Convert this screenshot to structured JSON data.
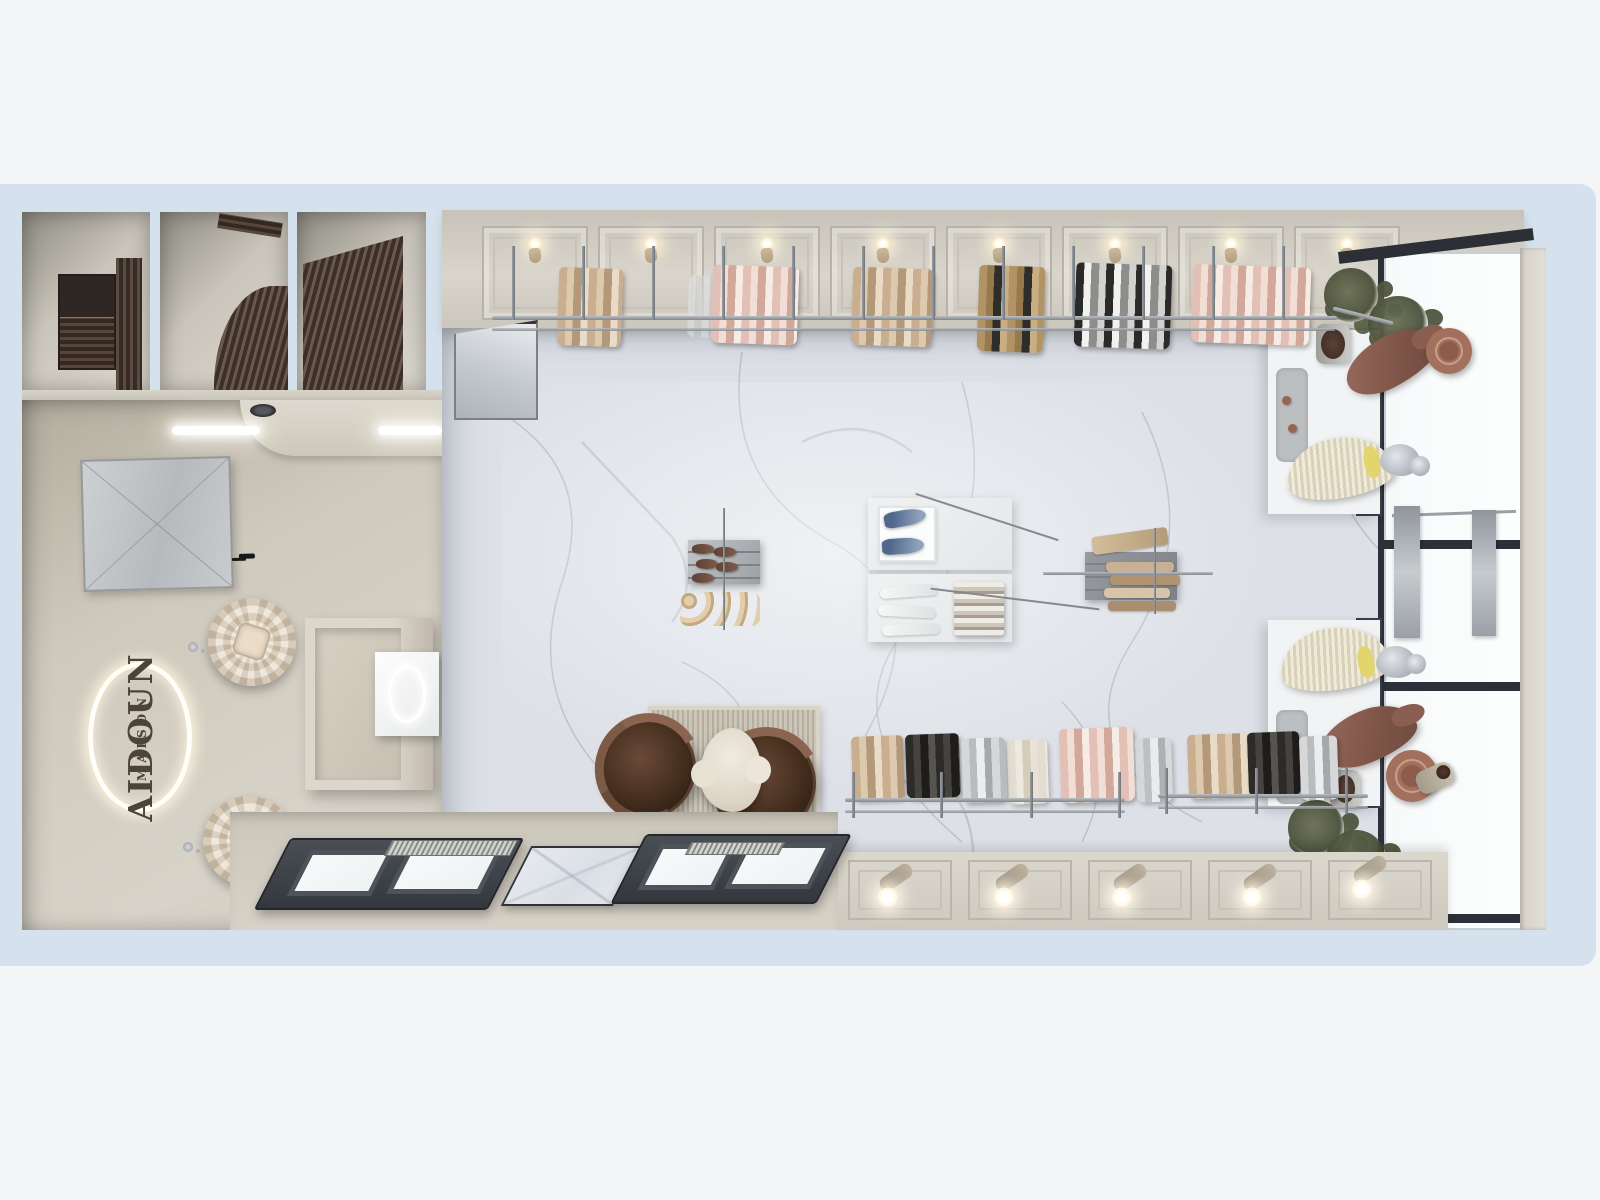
{
  "scene": {
    "description": "Top-down 3D render of the Aidoun Maison boutique interior on a pale blue site mat",
    "brand": {
      "line1": "AIDOUN",
      "line2": "MAISON"
    },
    "palette": {
      "page_background": "#f3f5f6",
      "site_mat_blue": "#d5e1ec",
      "marble_floor": "#dde1e7",
      "marble_vein": "#9aa3b1",
      "wall_beige": "#cfc9bd",
      "wood_panel_dark": "#3c2f28",
      "window_frame_dark": "#3a3f46",
      "mullion_navy": "#39414f",
      "glass_white": "#fbfdfd",
      "chair_leather_brown": "#47301f",
      "coat_brown": "#7d5447",
      "dress_cream": "#ede6d4",
      "sash_yellow": "#e3d56d",
      "shoe_denim_blue": "#51678b",
      "logo_ring_light": "#fffef6",
      "logo_letters": "#4c443b"
    },
    "areas": {
      "fitting_rooms_count": 3,
      "reception": "mirror, illuminated oval logo, cash desk, two flower sculptures",
      "retail_hall": "marble floor with hanging rails and display tables",
      "window_displays": "two white platforms with dressed mannequins and plants",
      "entrance": "dark-framed storefront windows and ribbed mats"
    },
    "fixtures": {
      "wall_sconces_top_row": 8,
      "floor_spotlights_bottom_row": 5,
      "garment_groups_top_rail": 6,
      "garment_groups_bottom_rails": 9,
      "armchairs": 2,
      "flower_sculptures": 2,
      "potted_plants": 2,
      "display_tables": 2,
      "denim_shoes_on_table": 2,
      "mannequins": [
        {
          "position": "upper window",
          "outfit": "brown coat with wide-brim hat"
        },
        {
          "position": "upper window",
          "outfit": "cream pleated dress with yellow sash"
        },
        {
          "position": "lower window",
          "outfit": "cream pleated dress with yellow sash"
        },
        {
          "position": "lower window",
          "outfit": "brown coat with wide-brim hat"
        }
      ]
    }
  }
}
